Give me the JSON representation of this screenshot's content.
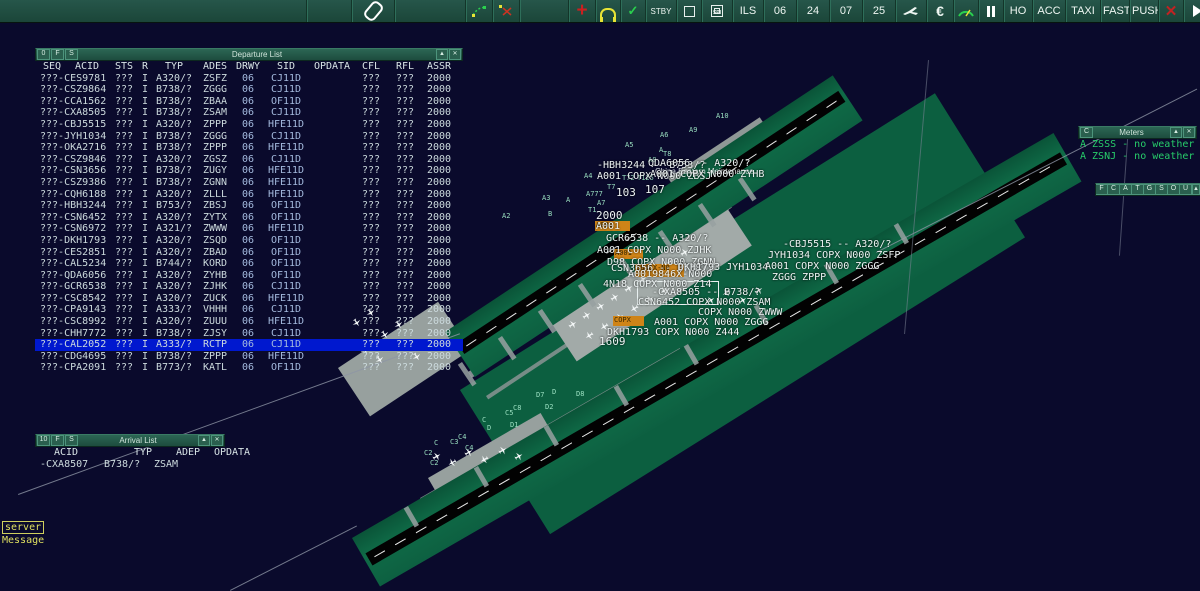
{
  "toolbar": {
    "stby": "STBY",
    "ils": "ILS",
    "runway_labels": [
      "06",
      "24",
      "07",
      "25"
    ],
    "ho": "HO",
    "acc": "ACC",
    "taxi": "TAXI",
    "fast": "FAST",
    "push": "PUSH"
  },
  "departure_list": {
    "window_buttons": [
      "0",
      "F",
      "S"
    ],
    "title": "Departure List",
    "minimize_glyph": "▲",
    "close_glyph": "✕",
    "headers": [
      "SEQ",
      "ACID",
      "STS",
      "R",
      "TYP",
      "ADES",
      "DRWY",
      "SID",
      "OPDATA",
      "CFL",
      "RFL",
      "ASSR"
    ],
    "selected_index": 23,
    "rows": [
      [
        "???-CES9781",
        "???",
        "I",
        "A320/?",
        "ZSFZ",
        "06",
        "CJ11D",
        "",
        "???",
        "???",
        "2000"
      ],
      [
        "???-CSZ9864",
        "???",
        "I",
        "B738/?",
        "ZGGG",
        "06",
        "CJ11D",
        "",
        "???",
        "???",
        "2000"
      ],
      [
        "???-CCA1562",
        "???",
        "I",
        "B738/?",
        "ZBAA",
        "06",
        "OF11D",
        "",
        "???",
        "???",
        "2000"
      ],
      [
        "???-CXA8505",
        "???",
        "I",
        "B738/?",
        "ZSAM",
        "06",
        "CJ11D",
        "",
        "???",
        "???",
        "2000"
      ],
      [
        "???-CBJ5515",
        "???",
        "I",
        "A320/?",
        "ZPPP",
        "06",
        "HFE11D",
        "",
        "???",
        "???",
        "2000"
      ],
      [
        "???-JYH1034",
        "???",
        "I",
        "B738/?",
        "ZGGG",
        "06",
        "CJ11D",
        "",
        "???",
        "???",
        "2000"
      ],
      [
        "???-OKA2716",
        "???",
        "I",
        "B738/?",
        "ZPPP",
        "06",
        "HFE11D",
        "",
        "???",
        "???",
        "2000"
      ],
      [
        "???-CSZ9846",
        "???",
        "I",
        "A320/?",
        "ZGSZ",
        "06",
        "CJ11D",
        "",
        "???",
        "???",
        "2000"
      ],
      [
        "???-CSN3656",
        "???",
        "I",
        "B738/?",
        "ZUGY",
        "06",
        "HFE11D",
        "",
        "???",
        "???",
        "2000"
      ],
      [
        "???-CSZ9386",
        "???",
        "I",
        "B738/?",
        "ZGNN",
        "06",
        "HFE11D",
        "",
        "???",
        "???",
        "2000"
      ],
      [
        "???-CQH6188",
        "???",
        "I",
        "A320/?",
        "ZLLL",
        "06",
        "HFE11D",
        "",
        "???",
        "???",
        "2000"
      ],
      [
        "???-HBH3244",
        "???",
        "I",
        "B753/?",
        "ZBSJ",
        "06",
        "OF11D",
        "",
        "???",
        "???",
        "2000"
      ],
      [
        "???-CSN6452",
        "???",
        "I",
        "A320/?",
        "ZYTX",
        "06",
        "OF11D",
        "",
        "???",
        "???",
        "2000"
      ],
      [
        "???-CSN6972",
        "???",
        "I",
        "A321/?",
        "ZWWW",
        "06",
        "HFE11D",
        "",
        "???",
        "???",
        "2000"
      ],
      [
        "???-DKH1793",
        "???",
        "I",
        "A320/?",
        "ZSQD",
        "06",
        "OF11D",
        "",
        "???",
        "???",
        "2000"
      ],
      [
        "???-CES2851",
        "???",
        "I",
        "A320/?",
        "ZBAD",
        "06",
        "OF11D",
        "",
        "???",
        "???",
        "2000"
      ],
      [
        "???-CAL5234",
        "???",
        "I",
        "B744/?",
        "KORD",
        "06",
        "OF11D",
        "",
        "???",
        "???",
        "2000"
      ],
      [
        "???-QDA6056",
        "???",
        "I",
        "A320/?",
        "ZYHB",
        "06",
        "OF11D",
        "",
        "???",
        "???",
        "2000"
      ],
      [
        "???-GCR6538",
        "???",
        "I",
        "A320/?",
        "ZJHK",
        "06",
        "CJ11D",
        "",
        "???",
        "???",
        "2000"
      ],
      [
        "???-CSC8542",
        "???",
        "I",
        "A320/?",
        "ZUCK",
        "06",
        "HFE11D",
        "",
        "???",
        "???",
        "2000"
      ],
      [
        "???-CPA9143",
        "???",
        "I",
        "A333/?",
        "VHHH",
        "06",
        "CJ11D",
        "",
        "???",
        "???",
        "2000"
      ],
      [
        "???-CSC8992",
        "???",
        "I",
        "A320/?",
        "ZUUU",
        "06",
        "HFE11D",
        "",
        "???",
        "???",
        "2000"
      ],
      [
        "???-CHH7772",
        "???",
        "I",
        "B738/?",
        "ZJSY",
        "06",
        "CJ11D",
        "",
        "???",
        "???",
        "2000"
      ],
      [
        "???-CAL2052",
        "???",
        "I",
        "A333/?",
        "RCTP",
        "06",
        "CJ11D",
        "",
        "???",
        "???",
        "2000"
      ],
      [
        "???-CDG4695",
        "???",
        "I",
        "B738/?",
        "ZPPP",
        "06",
        "HFE11D",
        "",
        "???",
        "???",
        "2000"
      ],
      [
        "???-CPA2091",
        "???",
        "I",
        "B773/?",
        "KATL",
        "06",
        "OF11D",
        "",
        "???",
        "???",
        "2000"
      ]
    ]
  },
  "arrival_list": {
    "window_buttons": [
      "10",
      "F",
      "S"
    ],
    "title": "Arrival List",
    "minimize_glyph": "▲",
    "close_glyph": "✕",
    "headers": [
      "ACID",
      "TYP",
      "ADEP",
      "OPDATA"
    ],
    "rows": [
      [
        "-CXA8507",
        "B738/?",
        "ZSAM",
        ""
      ]
    ]
  },
  "meters": {
    "window_buttons": [
      "C"
    ],
    "title": "Meters",
    "minimize_glyph": "▲",
    "close_glyph": "✕",
    "lines": [
      "A ZSSS - no weather",
      "A ZSNJ - no weather"
    ]
  },
  "mini_toolbar": {
    "buttons": [
      "F",
      "C",
      "A",
      "T",
      "G",
      "S",
      "O",
      "U"
    ],
    "minimize_glyph": "▲",
    "close_glyph": "✕"
  },
  "status": {
    "server_label": "server",
    "message_label": "Message"
  },
  "map": {
    "facility_label": "China Eastern Maintenance",
    "colors": {
      "selected_row": "#0018cf",
      "map_green": "#0f6b47",
      "amber": "#cf8418",
      "metar_green": "#27cd6a"
    },
    "taxiway_labels": [
      {
        "t": "A2",
        "x": 502,
        "y": 212
      },
      {
        "t": "A3",
        "x": 542,
        "y": 194
      },
      {
        "t": "A",
        "x": 566,
        "y": 196
      },
      {
        "t": "A4",
        "x": 584,
        "y": 172
      },
      {
        "t": "A777",
        "x": 586,
        "y": 190
      },
      {
        "t": "A7",
        "x": 597,
        "y": 199
      },
      {
        "t": "T1",
        "x": 588,
        "y": 206
      },
      {
        "t": "B",
        "x": 548,
        "y": 210
      },
      {
        "t": "T7",
        "x": 607,
        "y": 183
      },
      {
        "t": "T72",
        "x": 622,
        "y": 174
      },
      {
        "t": "T125",
        "x": 637,
        "y": 174
      },
      {
        "t": "A5",
        "x": 625,
        "y": 141
      },
      {
        "t": "A6",
        "x": 660,
        "y": 131
      },
      {
        "t": "A",
        "x": 659,
        "y": 146
      },
      {
        "t": "A8",
        "x": 648,
        "y": 156
      },
      {
        "t": "T8",
        "x": 663,
        "y": 150
      },
      {
        "t": "A9",
        "x": 689,
        "y": 126
      },
      {
        "t": "A10",
        "x": 716,
        "y": 112
      },
      {
        "t": "C2",
        "x": 424,
        "y": 449
      },
      {
        "t": "C2",
        "x": 430,
        "y": 459
      },
      {
        "t": "C",
        "x": 434,
        "y": 439
      },
      {
        "t": "C3",
        "x": 450,
        "y": 438
      },
      {
        "t": "C4",
        "x": 458,
        "y": 433
      },
      {
        "t": "C4",
        "x": 465,
        "y": 444
      },
      {
        "t": "C",
        "x": 482,
        "y": 416
      },
      {
        "t": "D",
        "x": 487,
        "y": 424
      },
      {
        "t": "C5",
        "x": 505,
        "y": 409
      },
      {
        "t": "C8",
        "x": 513,
        "y": 404
      },
      {
        "t": "D1",
        "x": 510,
        "y": 421
      },
      {
        "t": "D2",
        "x": 545,
        "y": 403
      },
      {
        "t": "D7",
        "x": 536,
        "y": 391
      },
      {
        "t": "D",
        "x": 552,
        "y": 388
      },
      {
        "t": "D8",
        "x": 576,
        "y": 390
      }
    ],
    "stand_labels": [
      {
        "t": "103",
        "x": 616,
        "y": 186
      },
      {
        "t": "107",
        "x": 645,
        "y": 183
      },
      {
        "t": "2000",
        "x": 596,
        "y": 209
      },
      {
        "t": "1609",
        "x": 599,
        "y": 335
      }
    ],
    "datablocks": [
      {
        "t": "-HBH3244 -- B753/?",
        "x": 597,
        "y": 160
      },
      {
        "t": "QDA6056 -- A320/?",
        "x": 648,
        "y": 158
      },
      {
        "t": "A001 COPX N000 ZBSJ",
        "x": 597,
        "y": 171
      },
      {
        "t": "A001 COPX N000 ZYHB",
        "x": 650,
        "y": 169
      },
      {
        "t": "A001",
        "x": 596,
        "y": 221
      },
      {
        "t": "GCR6538 -- A320/?",
        "x": 606,
        "y": 233
      },
      {
        "t": "A001 COPX N000 ZJHK",
        "x": 597,
        "y": 245
      },
      {
        "t": "D98 COPX N000 ZGNN",
        "x": 607,
        "y": 257
      },
      {
        "t": "CSN3656 -- B738/?",
        "x": 611,
        "y": 263
      },
      {
        "t": "A0019846X-N000",
        "x": 628,
        "y": 269
      },
      {
        "t": "DKH1793 JYH1034",
        "x": 678,
        "y": 262
      },
      {
        "t": "-CBJ5515 -- A320/?",
        "x": 783,
        "y": 239
      },
      {
        "t": "JYH1034 COPX N000 ZSFP",
        "x": 768,
        "y": 250
      },
      {
        "t": "A001 COPX N000 ZGGG",
        "x": 765,
        "y": 261
      },
      {
        "t": "ZGGG ZPPP",
        "x": 772,
        "y": 272
      },
      {
        "t": "4N18 COPX N000 Z14",
        "x": 603,
        "y": 279
      },
      {
        "t": "-CXA8505 -- B738/?",
        "x": 652,
        "y": 287
      },
      {
        "t": "CSN6452 COPX N000 ZSAM",
        "x": 638,
        "y": 297
      },
      {
        "t": "COPX N000 ZWWW",
        "x": 698,
        "y": 307
      },
      {
        "t": "A001 COPX N000 ZGGG",
        "x": 654,
        "y": 317
      },
      {
        "t": "DKH1793 COPX N000 Z444",
        "x": 607,
        "y": 327
      }
    ],
    "amber_chips": [
      {
        "x": 595,
        "y": 221,
        "w": 34,
        "h": 10,
        "t": "A001"
      },
      {
        "x": 614,
        "y": 249,
        "w": 28,
        "h": 10,
        "t": "A001"
      },
      {
        "x": 635,
        "y": 264,
        "w": 48,
        "h": 13,
        "t": "9846X-N0"
      },
      {
        "x": 613,
        "y": 316,
        "w": 30,
        "h": 10,
        "t": "COPX"
      }
    ],
    "select_box": {
      "x": 637,
      "y": 281,
      "w": 80,
      "h": 22
    },
    "aircraft": [
      {
        "x": 568,
        "y": 320,
        "r": 57
      },
      {
        "x": 582,
        "y": 311,
        "r": 57
      },
      {
        "x": 596,
        "y": 302,
        "r": 57
      },
      {
        "x": 610,
        "y": 293,
        "r": 57
      },
      {
        "x": 624,
        "y": 284,
        "r": 57
      },
      {
        "x": 638,
        "y": 275,
        "r": 57
      },
      {
        "x": 652,
        "y": 266,
        "r": 57
      },
      {
        "x": 666,
        "y": 257,
        "r": 57
      },
      {
        "x": 680,
        "y": 248,
        "r": 57
      },
      {
        "x": 585,
        "y": 331,
        "r": 237
      },
      {
        "x": 600,
        "y": 322,
        "r": 237
      },
      {
        "x": 615,
        "y": 313,
        "r": 57
      },
      {
        "x": 630,
        "y": 304,
        "r": 237
      },
      {
        "x": 645,
        "y": 295,
        "r": 57
      },
      {
        "x": 660,
        "y": 286,
        "r": 237
      },
      {
        "x": 352,
        "y": 318,
        "r": 147
      },
      {
        "x": 366,
        "y": 308,
        "r": 147
      },
      {
        "x": 380,
        "y": 330,
        "r": 147
      },
      {
        "x": 394,
        "y": 320,
        "r": 147
      },
      {
        "x": 360,
        "y": 345,
        "r": 147
      },
      {
        "x": 375,
        "y": 355,
        "r": 147
      },
      {
        "x": 400,
        "y": 340,
        "r": 147
      },
      {
        "x": 412,
        "y": 352,
        "r": 147
      },
      {
        "x": 432,
        "y": 452,
        "r": 60
      },
      {
        "x": 448,
        "y": 458,
        "r": 240
      },
      {
        "x": 464,
        "y": 448,
        "r": 60
      },
      {
        "x": 480,
        "y": 455,
        "r": 240
      },
      {
        "x": 498,
        "y": 446,
        "r": 60
      },
      {
        "x": 514,
        "y": 452,
        "r": 60
      },
      {
        "x": 706,
        "y": 296,
        "r": 57
      },
      {
        "x": 722,
        "y": 288,
        "r": 237
      },
      {
        "x": 738,
        "y": 296,
        "r": 57
      },
      {
        "x": 754,
        "y": 286,
        "r": 57
      }
    ]
  }
}
